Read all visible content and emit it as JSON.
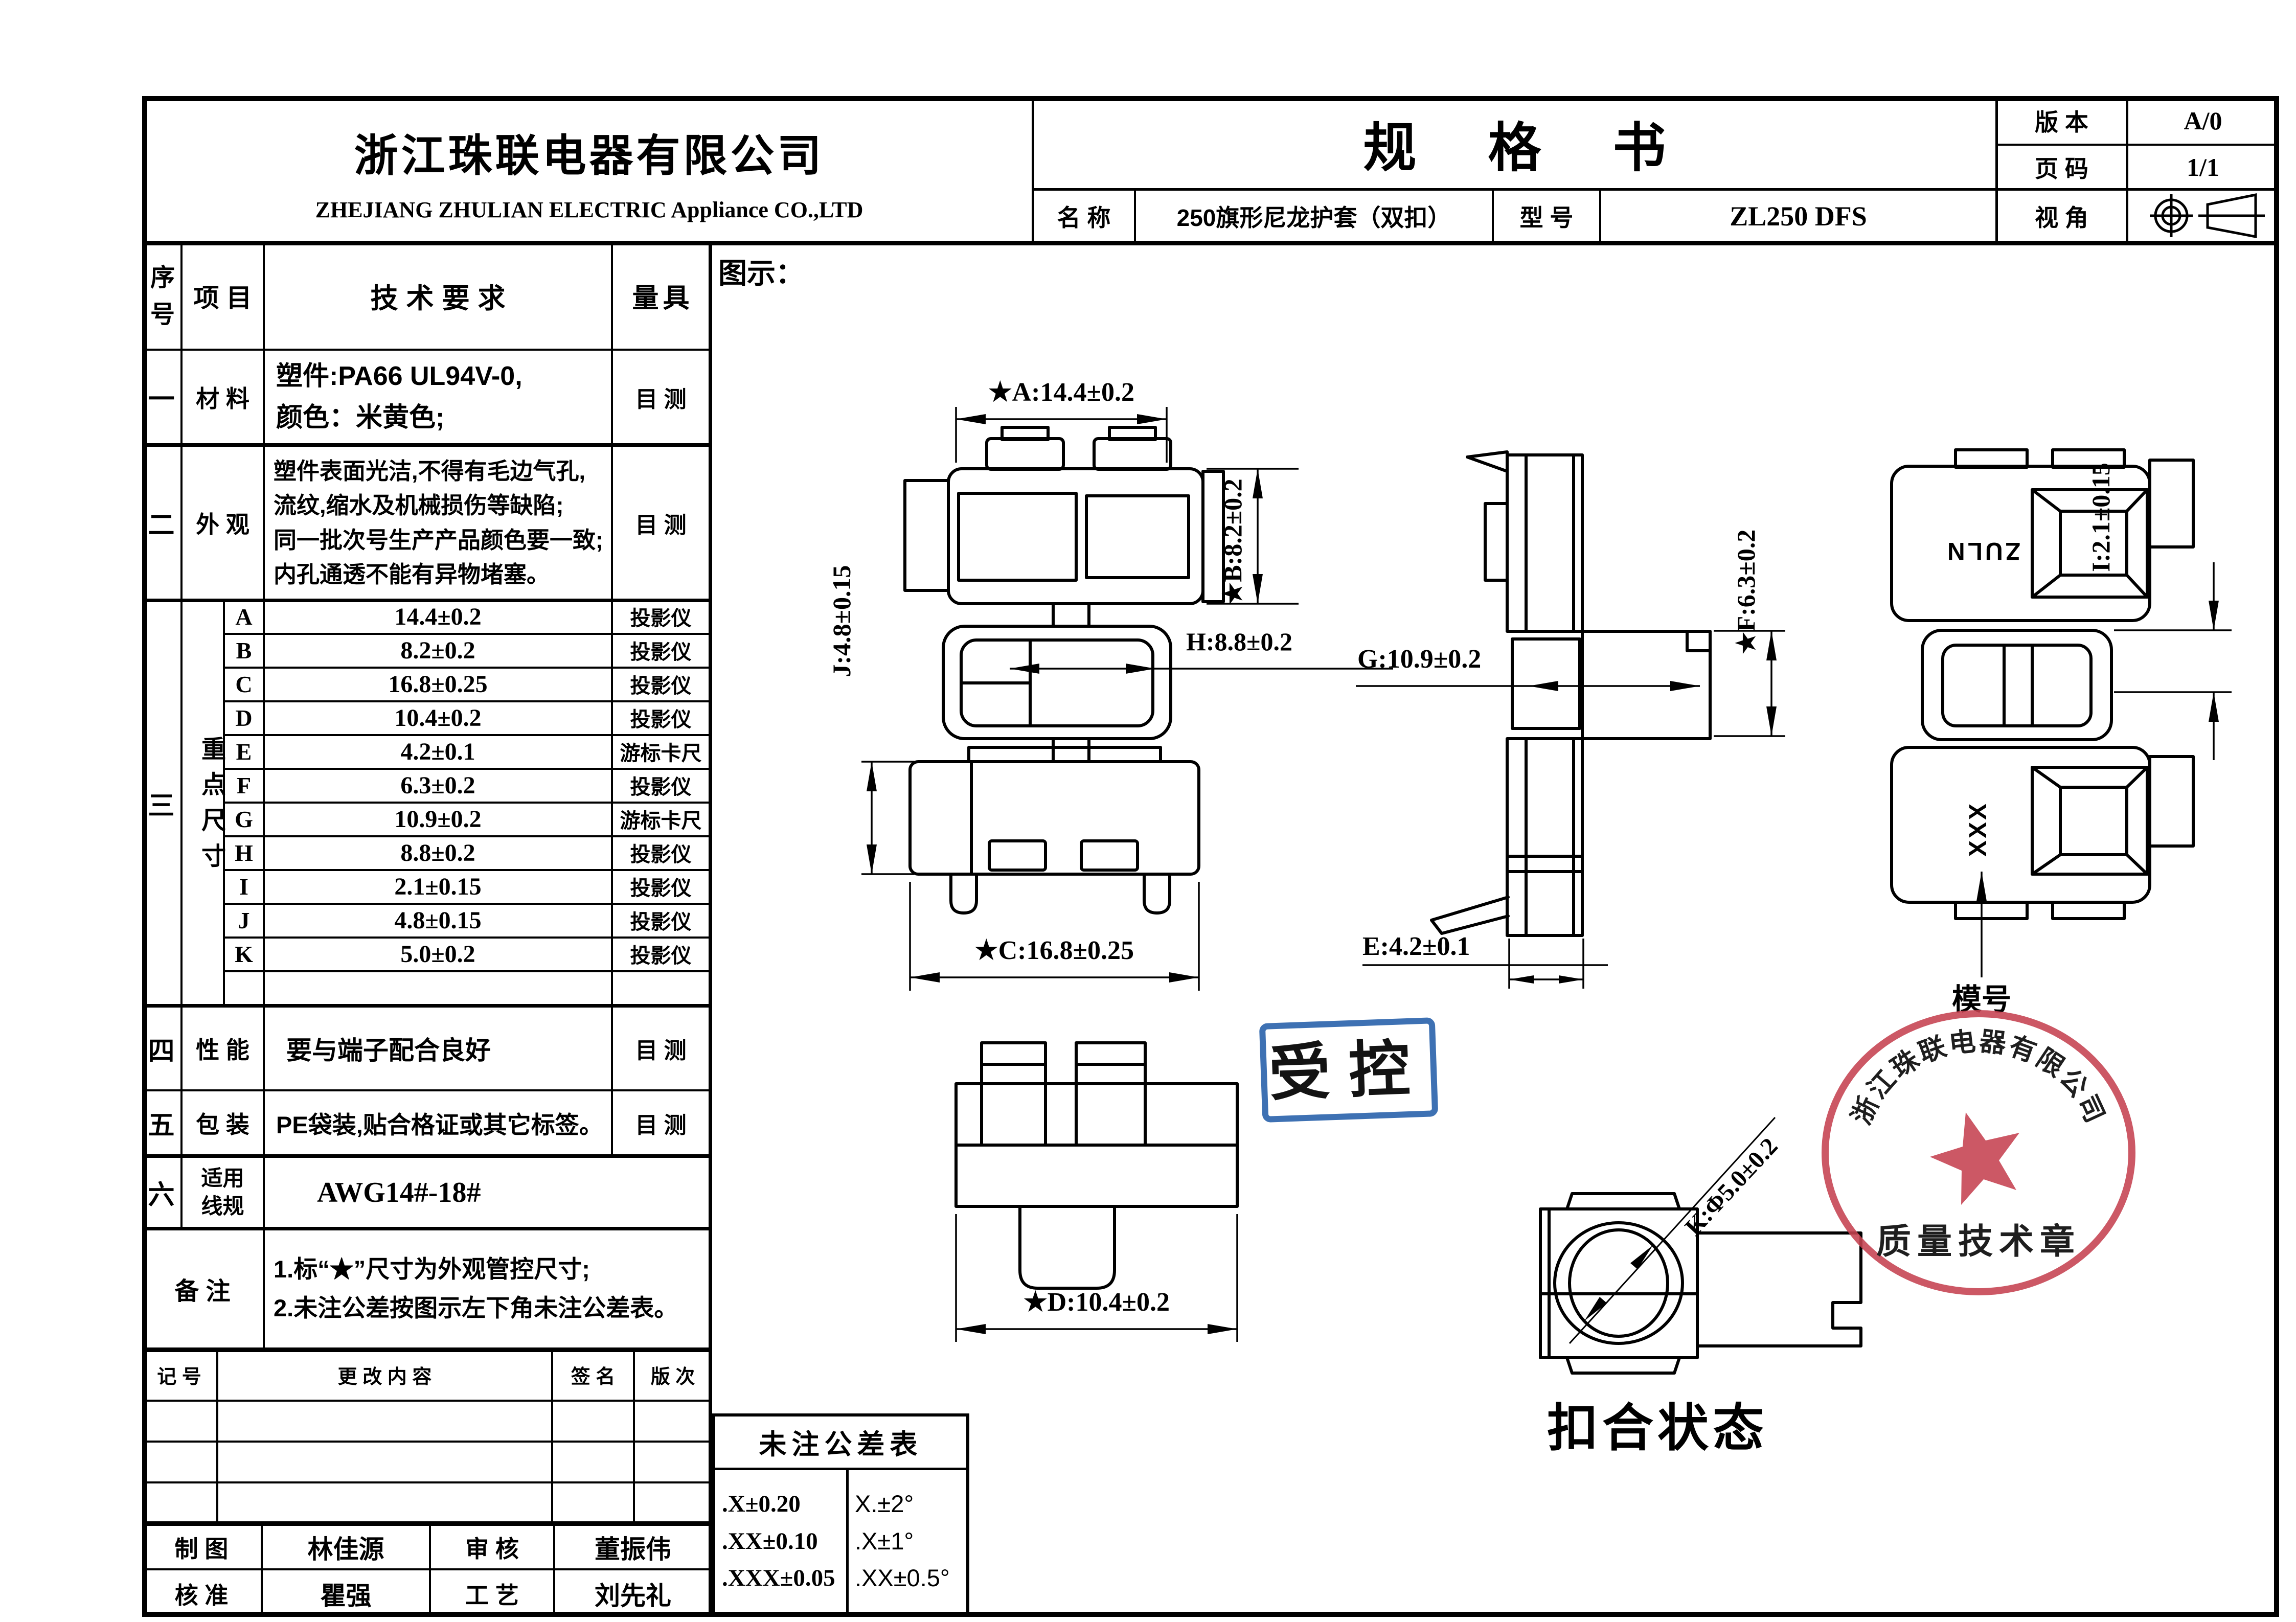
{
  "header": {
    "company_cn": "浙江珠联电器有限公司",
    "company_en": "ZHEJIANG ZHULIAN ELECTRIC Appliance CO.,LTD",
    "doc_title": "规格书",
    "version_label": "版 本",
    "version_value": "A/0",
    "page_label": "页 码",
    "page_value": "1/1",
    "name_label": "名 称",
    "name_value": "250旗形尼龙护套（双扣）",
    "model_label": "型 号",
    "model_value": "ZL250 DFS",
    "view_label": "视 角"
  },
  "spec_table": {
    "col_seq": "序号",
    "col_item": "项目",
    "col_req": "技术要求",
    "col_gauge": "量具",
    "row1": {
      "seq": "一",
      "item": "材 料",
      "req_lines": [
        "塑件:PA66  UL94V-0,",
        "颜色：米黄色;"
      ],
      "gauge": "目 测"
    },
    "row2": {
      "seq": "二",
      "item": "外 观",
      "req_lines": [
        "塑件表面光洁,不得有毛边气孔,",
        "流纹,缩水及机械损伤等缺陷;",
        "同一批次号生产产品颜色要一致;",
        "内孔通透不能有异物堵塞。"
      ],
      "gauge": "目 测"
    },
    "dims_section": {
      "seq": "三",
      "item": "重点尺寸",
      "rows": [
        {
          "letter": "A",
          "value": "14.4±0.2",
          "gauge": "投影仪"
        },
        {
          "letter": "B",
          "value": "8.2±0.2",
          "gauge": "投影仪"
        },
        {
          "letter": "C",
          "value": "16.8±0.25",
          "gauge": "投影仪"
        },
        {
          "letter": "D",
          "value": "10.4±0.2",
          "gauge": "投影仪"
        },
        {
          "letter": "E",
          "value": "4.2±0.1",
          "gauge": "游标卡尺"
        },
        {
          "letter": "F",
          "value": "6.3±0.2",
          "gauge": "投影仪"
        },
        {
          "letter": "G",
          "value": "10.9±0.2",
          "gauge": "游标卡尺"
        },
        {
          "letter": "H",
          "value": "8.8±0.2",
          "gauge": "投影仪"
        },
        {
          "letter": "I",
          "value": "2.1±0.15",
          "gauge": "投影仪"
        },
        {
          "letter": "J",
          "value": "4.8±0.15",
          "gauge": "投影仪"
        },
        {
          "letter": "K",
          "value": "5.0±0.2",
          "gauge": "投影仪"
        }
      ]
    },
    "row4": {
      "seq": "四",
      "item": "性 能",
      "req": "要与端子配合良好",
      "gauge": "目 测"
    },
    "row5": {
      "seq": "五",
      "item": "包 装",
      "req": "PE袋装,贴合格证或其它标签。",
      "gauge": "目 测"
    },
    "row6": {
      "seq": "六",
      "item_lines": [
        "适用",
        "线规"
      ],
      "req": "AWG14#-18#"
    },
    "remark": {
      "label": "备 注",
      "lines": [
        "1.标“★”尺寸为外观管控尺寸;",
        "2.未注公差按图示左下角未注公差表。"
      ]
    }
  },
  "revision_table": {
    "mark": "记 号",
    "content": "更 改 内 容",
    "sign": "签 名",
    "rev": "版 次"
  },
  "signoff": {
    "draw_label": "制 图",
    "draw_name": "林佳源",
    "check_label": "审 核",
    "check_name": "董振伟",
    "approve_label": "核 准",
    "approve_name": "瞿强",
    "process_label": "工 艺",
    "process_name": "刘先礼"
  },
  "tolerance_table": {
    "title": "未注公差表",
    "linear": [
      ".X±0.20",
      ".XX±0.10",
      ".XXX±0.05"
    ],
    "angular": [
      "X.±2°",
      ".X±1°",
      ".XX±0.5°"
    ]
  },
  "drawing": {
    "section_label": "图示：",
    "dim_A": "★A:14.4±0.2",
    "dim_B": "★B:8.2±0.2",
    "dim_C": "★C:16.8±0.25",
    "dim_D": "★D:10.4±0.2",
    "dim_E": "E:4.2±0.1",
    "dim_F": "★F:6.3±0.2",
    "dim_G": "G:10.9±0.2",
    "dim_H": "H:8.8±0.2",
    "dim_I": "I:2.1±0.15",
    "dim_J": "J:4.8±0.15",
    "dim_K": "K:Φ5.0±0.2",
    "marking_top": "ZULN",
    "marking_bottom": "XXX",
    "mold_label": "模号",
    "state_label": "扣合状态"
  },
  "stamps": {
    "controlled": "受控",
    "quality_company": "浙江珠联电器有限公司",
    "quality_title": "质量技术章"
  },
  "colors": {
    "stamp_blue": "#2e66ad",
    "stamp_red": "#c64250",
    "line": "#000000"
  }
}
